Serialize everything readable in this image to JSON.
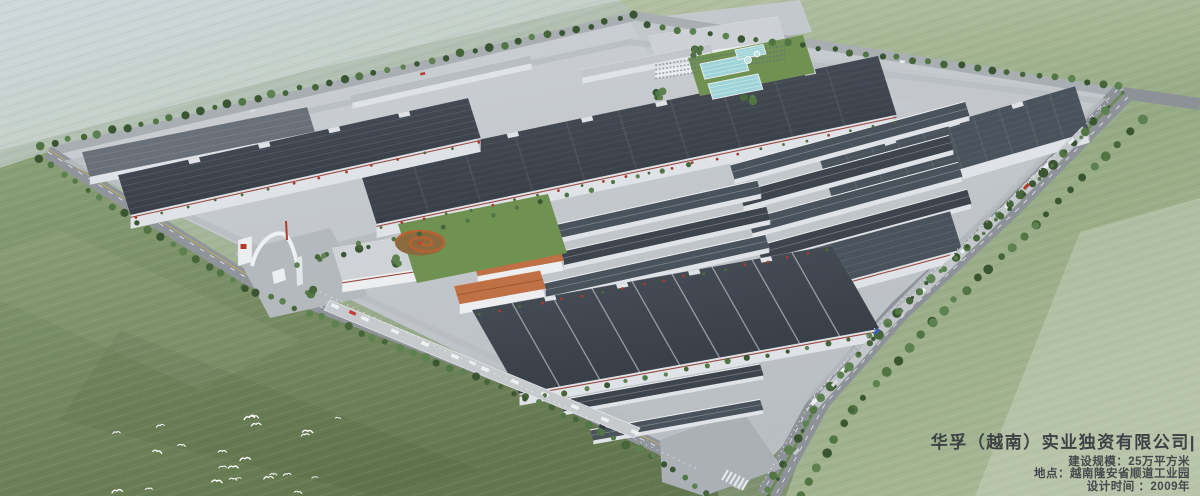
{
  "caption": {
    "title": "华孚（越南）实业独资有限公司|",
    "lines": [
      "建设规模：25万平方米",
      "地点：越南隆安省顺道工业园",
      "设计时间 ：2009年"
    ]
  },
  "colors": {
    "field_pale": "#bcc9cf",
    "field_sage": "#9eb190",
    "field_green": "#8aa076",
    "field_dark": "#6d8259",
    "park_ground": "#c7cbcf",
    "road": "#94999e",
    "road_light": "#b7bcc1",
    "roof_dark": "#3e444c",
    "roof_mid": "#4a525b",
    "roof_light": "#6a7077",
    "wall_white": "#e3e6e9",
    "pool_teal": "#9ed4d8",
    "orange_roof": "#bf7044",
    "tree_green": "#476538",
    "accent_red": "#9a4a42",
    "text": "#3d4145",
    "bird_white": "#ffffff"
  }
}
